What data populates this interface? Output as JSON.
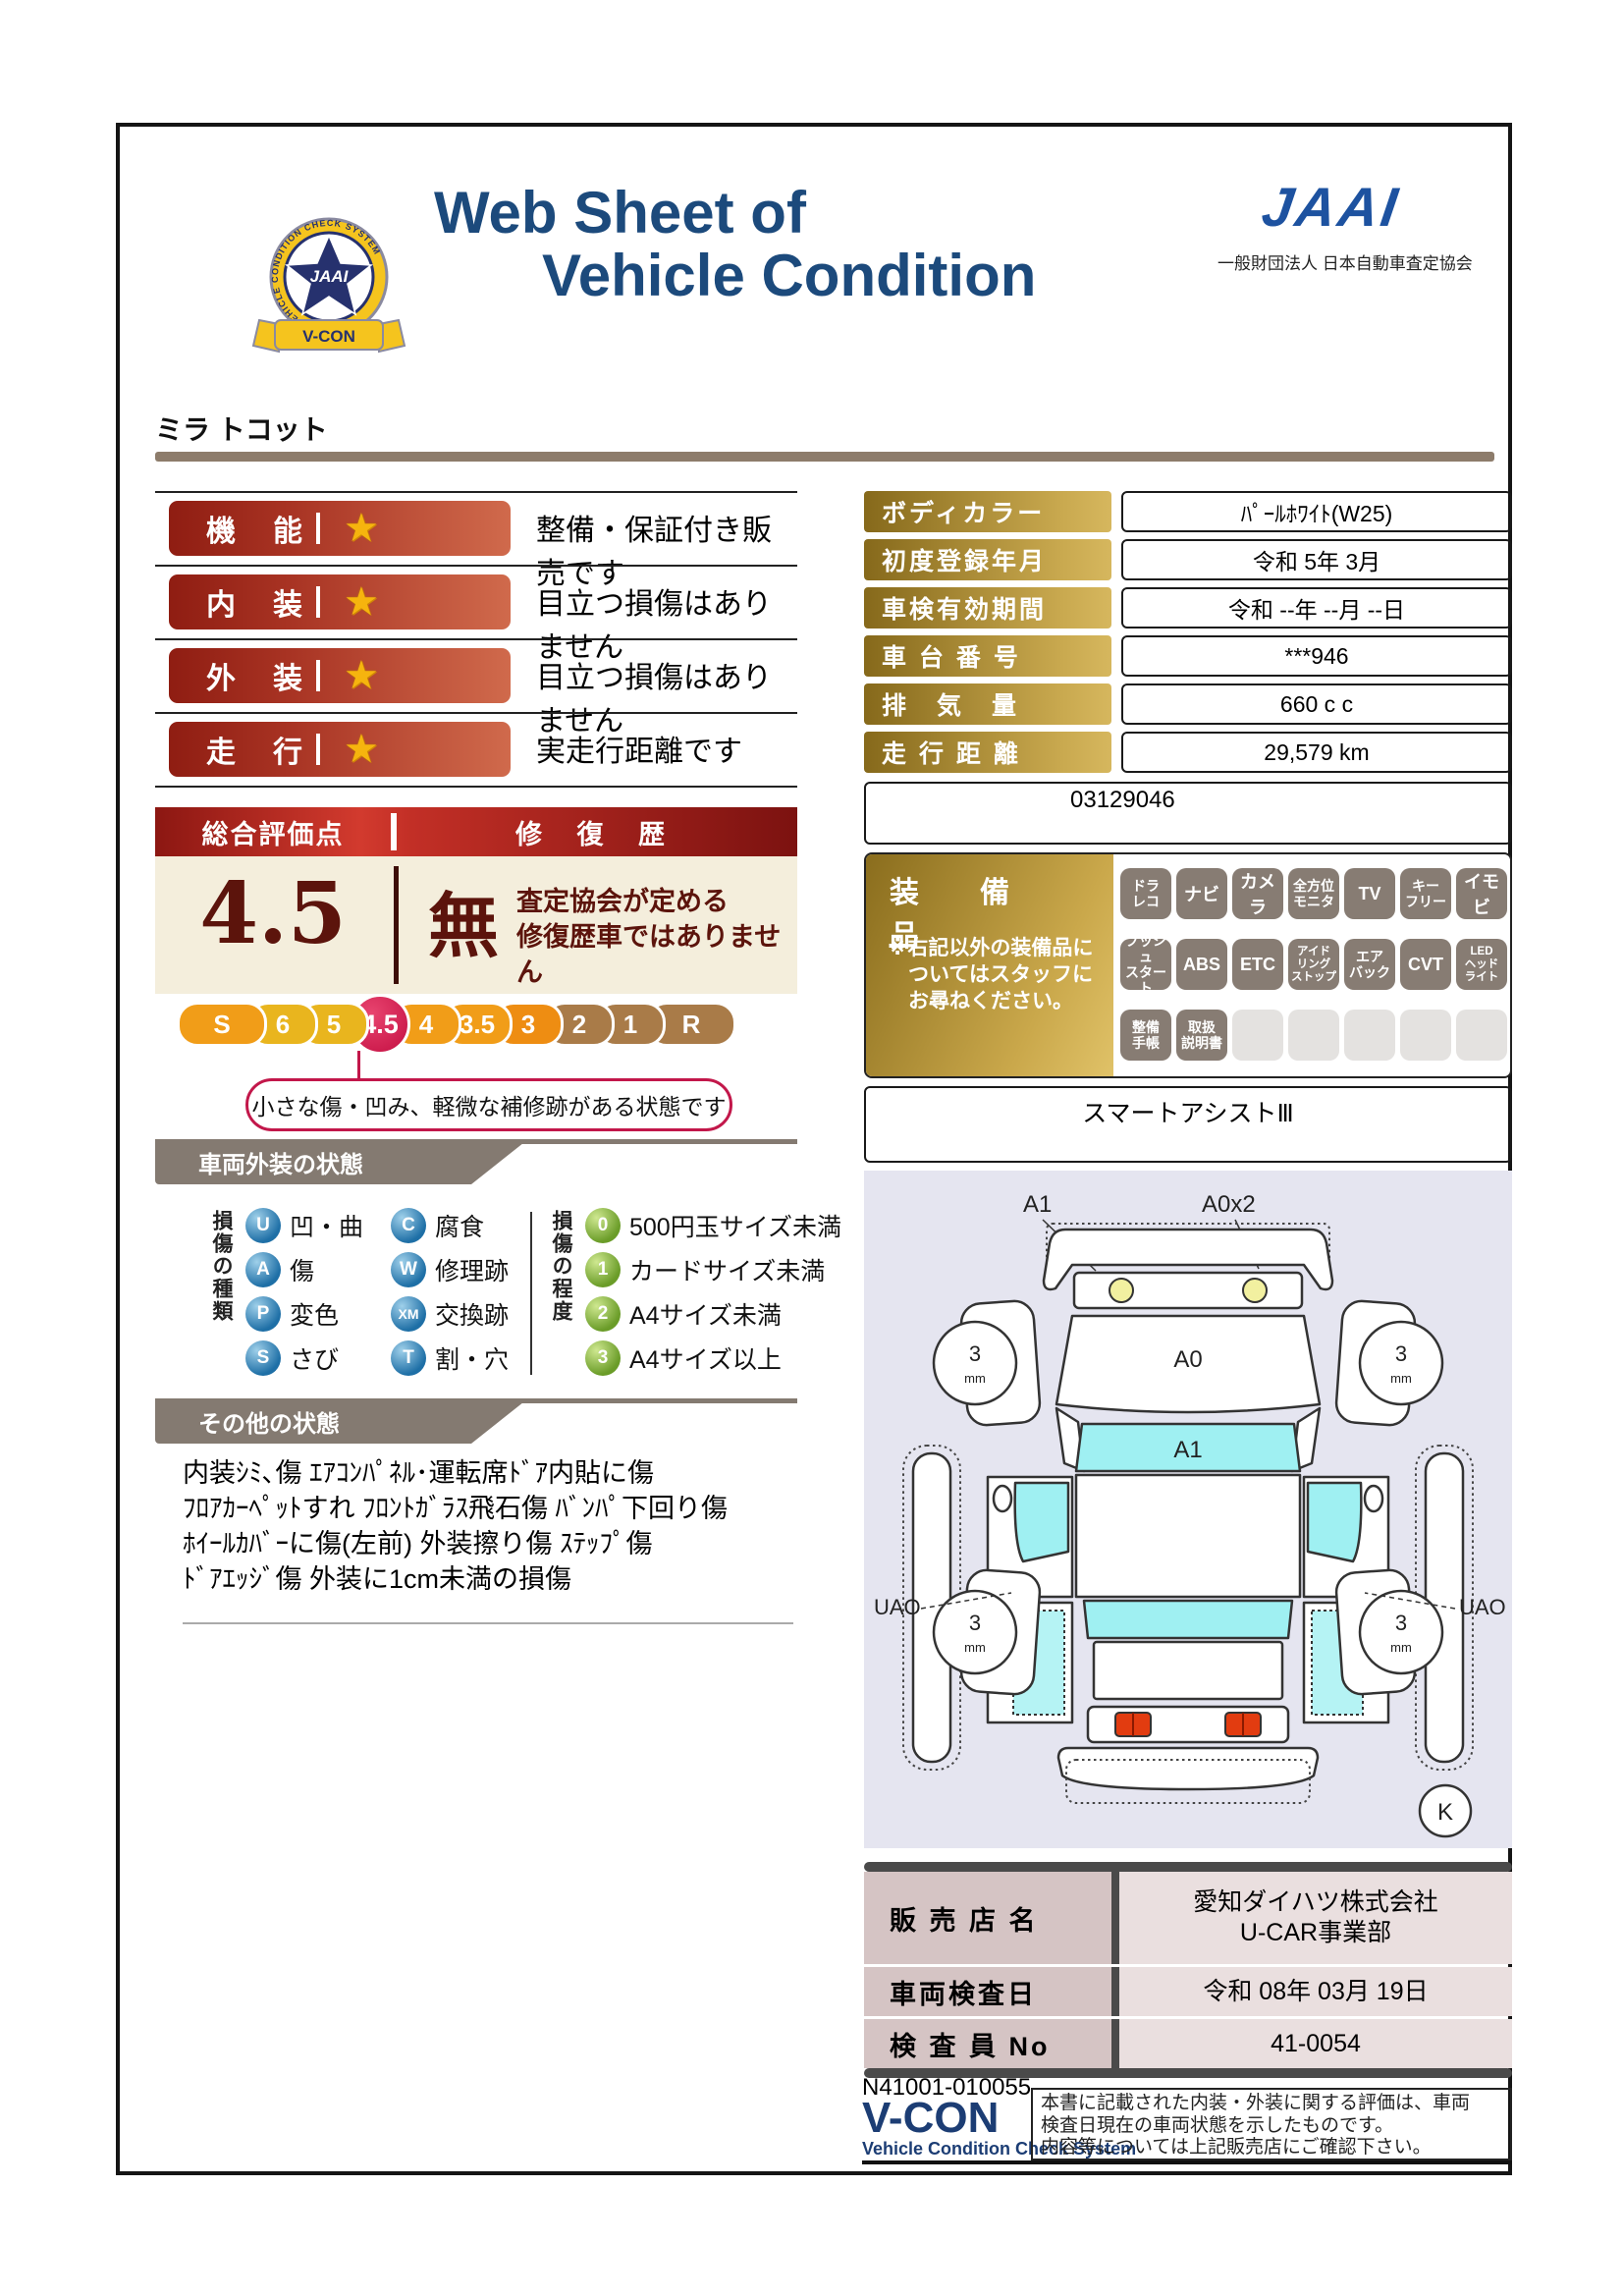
{
  "header": {
    "title_line1": "Web Sheet of",
    "title_line2": "Vehicle Condition",
    "jaai_logo_text": "JAAI",
    "jaai_org": "一般財団法人 日本自動車査定協会",
    "emblem": {
      "ring_text": "VEHICLE CONDITION CHECK SYSTEM",
      "star_text": "JAAI",
      "ribbon_text": "V-CON"
    }
  },
  "vehicle_name": "ミラ トコット",
  "ratings": [
    {
      "label": "機　能",
      "star": "★",
      "desc": "整備・保証付き販売です"
    },
    {
      "label": "内　装",
      "star": "★",
      "desc": "目立つ損傷はありません"
    },
    {
      "label": "外　装",
      "star": "★",
      "desc": "目立つ損傷はありません"
    },
    {
      "label": "走　行",
      "star": "★",
      "desc": "実走行距離です"
    }
  ],
  "overall": {
    "header_left": "総合評価点",
    "header_right": "修 復 歴",
    "score": "4.5",
    "repair_mark": "無",
    "repair_desc_lines": [
      "査定協会が定める",
      "修復歴車ではありません"
    ],
    "scale": [
      {
        "label": "S",
        "type": "orange"
      },
      {
        "label": "6",
        "type": "gold"
      },
      {
        "label": "5",
        "type": "gold"
      },
      {
        "label": "4.5",
        "type": "active"
      },
      {
        "label": "4",
        "type": "orange"
      },
      {
        "label": "3.5",
        "type": "orange"
      },
      {
        "label": "3",
        "type": "orange2"
      },
      {
        "label": "2",
        "type": "brown"
      },
      {
        "label": "1",
        "type": "brown"
      },
      {
        "label": "R",
        "type": "brown"
      }
    ],
    "callout": "小さな傷・凹み、軽微な補修跡がある状態です"
  },
  "info_table": {
    "rows": [
      {
        "label": "ボディカラー",
        "value": "ﾊﾟｰﾙﾎﾜｲﾄ(W25)"
      },
      {
        "label": "初度登録年月",
        "value": "令和 5年 3月"
      },
      {
        "label": "車検有効期間",
        "value": "令和 --年 --月 --日"
      },
      {
        "label": "車 台 番 号",
        "value": "***946"
      },
      {
        "label": "排　気　量",
        "value": "660 c c"
      },
      {
        "label": "走 行 距 離",
        "value": "29,579 km"
      }
    ],
    "remark": "03129046"
  },
  "equipment": {
    "title": "装　備　品",
    "note_lines": [
      "※右記以外の装備品に",
      "ついてはスタッフに",
      "お尋ねください。"
    ],
    "rows": [
      [
        [
          "ドラ",
          "レコ"
        ],
        [
          "ナビ"
        ],
        [
          "カメラ"
        ],
        [
          "全方位",
          "モニタ"
        ],
        [
          "TV"
        ],
        [
          "キー",
          "フリー"
        ],
        [
          "イモビ"
        ]
      ],
      [
        [
          "プッシュ",
          "スタート"
        ],
        [
          "ABS"
        ],
        [
          "ETC"
        ],
        [
          "アイド",
          "リング",
          "ストップ"
        ],
        [
          "エア",
          "バック"
        ],
        [
          "CVT"
        ],
        [
          "LED",
          "ヘッド",
          "ライト"
        ]
      ],
      [
        [
          "整備",
          "手帳"
        ],
        [
          "取扱",
          "説明書"
        ],
        null,
        null,
        null,
        null,
        null
      ]
    ],
    "smart_assist": "スマートアシストⅢ"
  },
  "exterior": {
    "section_title": "車両外装の状態",
    "kind_title": "損傷の種類",
    "kinds_col1": [
      {
        "code": "U",
        "label": "凹・曲"
      },
      {
        "code": "A",
        "label": "傷"
      },
      {
        "code": "P",
        "label": "変色"
      },
      {
        "code": "S",
        "label": "さび"
      }
    ],
    "kinds_col2": [
      {
        "code": "C",
        "label": "腐食"
      },
      {
        "code": "W",
        "label": "修理跡"
      },
      {
        "code": "XM",
        "label": "交換跡"
      },
      {
        "code": "T",
        "label": "割・穴"
      }
    ],
    "degree_title": "損傷の程度",
    "degrees": [
      {
        "code": "0",
        "label": "500円玉サイズ未満"
      },
      {
        "code": "1",
        "label": "カードサイズ未満"
      },
      {
        "code": "2",
        "label": "A4サイズ未満"
      },
      {
        "code": "3",
        "label": "A4サイズ以上"
      }
    ]
  },
  "other": {
    "section_title": "その他の状態",
    "lines": [
      "内装ｼﾐ､傷 ｴｱｺﾝﾊﾟﾈﾙ･運転席ﾄﾞｱ内貼に傷",
      "ﾌﾛｱｶｰﾍﾟｯﾄすれ ﾌﾛﾝﾄｶﾞﾗｽ飛石傷 ﾊﾞﾝﾊﾟ下回り傷",
      "ﾎｲｰﾙｶﾊﾞｰに傷(左前) 外装擦り傷 ｽﾃｯﾌﾟ傷",
      "ﾄﾞｱｴｯｼﾞ傷 外装に1cm未満の損傷"
    ]
  },
  "diagram": {
    "front_left_label": "A1",
    "front_right_label": "A0x2",
    "hood_label": "A0",
    "windshield_label": "A1",
    "side_left_label": "UAO",
    "side_right_label": "UAO",
    "tire_depth": "3",
    "tire_unit": "mm",
    "corner_mark": "K"
  },
  "dealer_table": {
    "rows": [
      {
        "label": "販 売 店 名",
        "lines": [
          "愛知ダイハツ株式会社",
          "U-CAR事業部"
        ]
      },
      {
        "label": "車両検査日",
        "lines": [
          "令和 08年 03月 19日"
        ]
      },
      {
        "label": "検 査 員 No",
        "lines": [
          "41-0054"
        ]
      }
    ]
  },
  "footer": {
    "code": "N41001-010055",
    "vcon_logo": "V-CON",
    "vcon_sub": "Vehicle Condition Check System",
    "note_lines": [
      "本書に記載された内装・外装に関する評価は、車両",
      "検査日現在の車両状態を示したものです。",
      "内容等については上記販売店にご確認下さい。"
    ]
  },
  "colors": {
    "title_navy": "#1c4a7c",
    "jaai_blue": "#1d52a0",
    "pill_red_dark": "#8f1d12",
    "pill_red_light": "#d06a4c",
    "cream": "#f4eedc",
    "maroon": "#5c140c",
    "scale_active": "#c40f42",
    "gold": "#c9a94f",
    "badge_gray": "#877c73",
    "banner_gray": "#847a71",
    "dealer_label_bg": "#d5c4c4",
    "diagram_bg": "#e5e5f0",
    "window_cyan": "#9ff0f2"
  }
}
